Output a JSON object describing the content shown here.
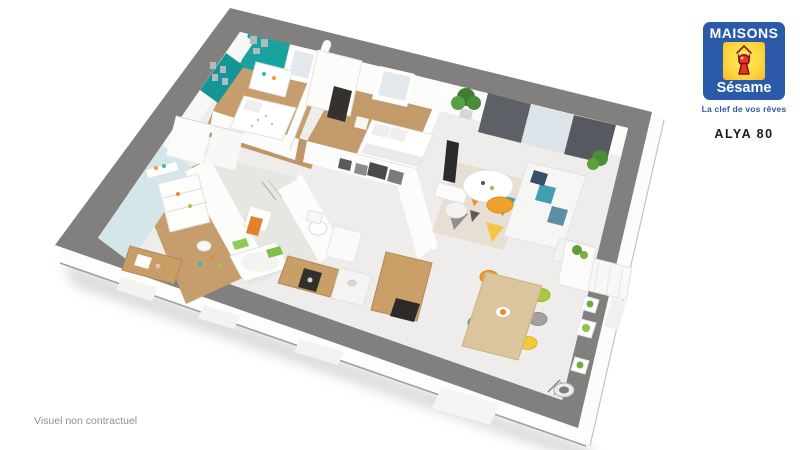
{
  "page": {
    "background": "#ffffff"
  },
  "logo": {
    "brand_top": "MAISONS",
    "brand_bottom": "Sésame",
    "tagline": "La clef de vos rêves",
    "colors": {
      "blue": "#2a5aa8",
      "yellow": "#ffd83e",
      "yellow_edge": "#f4b92e",
      "keyhole_red": "#e8352a",
      "keyhole_dark_red": "#7a1410",
      "text_white": "#ffffff"
    }
  },
  "plan_label": {
    "model_name": "ALYA 80"
  },
  "footer": {
    "disclaimer": "Visuel non contractuel"
  },
  "floorplan": {
    "type": "3d-floor-plan-render",
    "rooms": [
      "child-bedroom",
      "bedroom-2",
      "bedroom-3",
      "bathroom",
      "wc",
      "hallway",
      "kitchen",
      "dining-area",
      "living-room"
    ],
    "colors": {
      "wall_top_gray": "#82807f",
      "exterior_white": "#fcfcfb",
      "floor_wood": "#c69d6d",
      "floor_light": "#eeedeb",
      "accent_teal": "#1aa2a1",
      "accent_light_blue": "#d5e6ea",
      "curtain_gray": "#5d6167",
      "plant_green": "#5f9e3a",
      "chair_orange": "#f09e2a",
      "chair_teal": "#3ab4c4",
      "chair_yellow": "#f4c83e",
      "chair_green": "#a9c93a",
      "table_wood": "#dcc49c",
      "appliance_dark": "#332f2b"
    }
  }
}
